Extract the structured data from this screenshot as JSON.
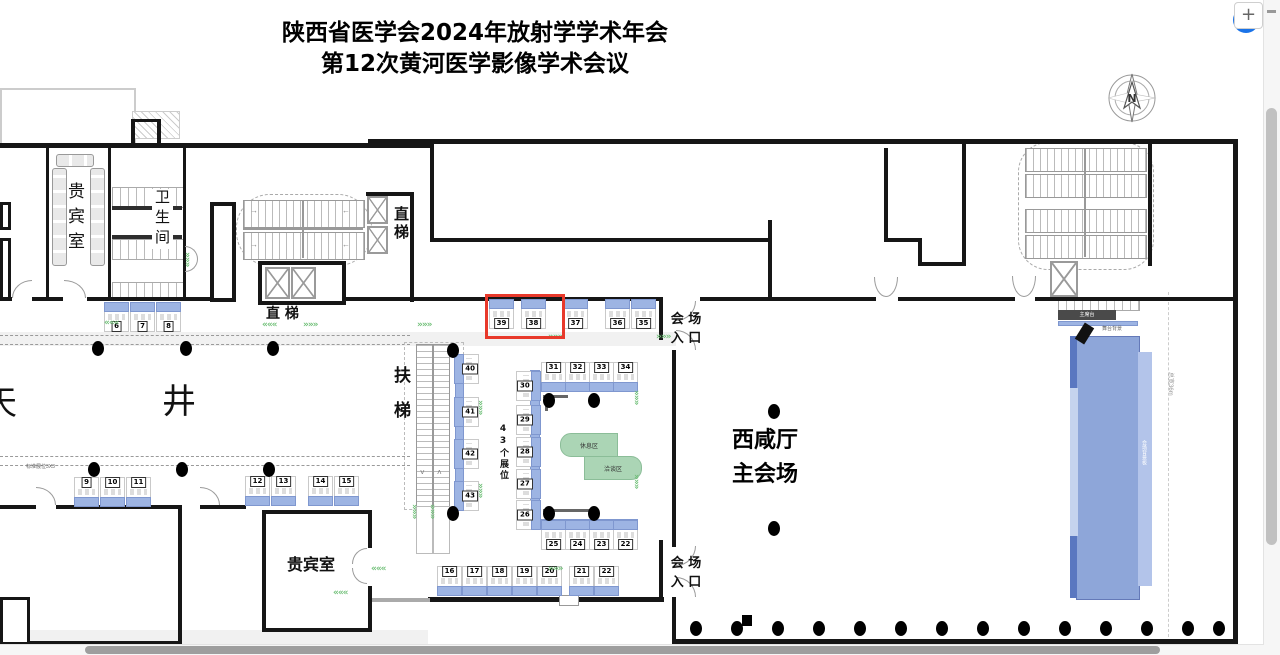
{
  "title": {
    "line1": "陕西省医学会2024年放射学学术年会",
    "line2": "第12次黄河医学影像学术会议"
  },
  "toolbar": {
    "zoom_in": "+"
  },
  "compass": {
    "north": "N"
  },
  "labels": {
    "vip_room_top": "贵宾室",
    "restroom": "卫生间",
    "elevator_center": "直 梯",
    "elevator_right": "直梯",
    "escalator": "扶梯",
    "atrium_left": "天",
    "atrium_right": "井",
    "booth_count": "43个展位",
    "vip_room_bottom": "贵宾室",
    "hall_line1": "西咸厅",
    "hall_line2": "主会场",
    "entrance_top_l1": "会 场",
    "entrance_top_l2": "入 口",
    "entrance_bottom_l1": "会 场",
    "entrance_bottom_l2": "入 口",
    "rest_area_top": "休息区",
    "rest_area_bottom": "洽谈区",
    "stage_bar": "主席台",
    "stage_note": "舞台背景",
    "stage_board": "会场背景板",
    "width_note": "总宽36m",
    "standard_booth_note": "标准展位3X3"
  },
  "colors": {
    "booth_blue": "#9db4e3",
    "highlight_red": "#e8392b",
    "chevron_green": "#6fbf77",
    "stage_green": "#abd5b5",
    "stage_blue": "#8ea6d9",
    "accent_blue": "#1a73e8"
  },
  "highlight": {
    "x": 485,
    "y": 294,
    "w": 74,
    "h": 39
  },
  "booths": [
    {
      "n": "6",
      "x": 104,
      "y": 302,
      "s": "N"
    },
    {
      "n": "7",
      "x": 130,
      "y": 302,
      "s": "N"
    },
    {
      "n": "8",
      "x": 156,
      "y": 302,
      "s": "N"
    },
    {
      "n": "39",
      "x": 489,
      "y": 299,
      "s": "N"
    },
    {
      "n": "38",
      "x": 521,
      "y": 299,
      "s": "N"
    },
    {
      "n": "37",
      "x": 563,
      "y": 299,
      "s": "N"
    },
    {
      "n": "36",
      "x": 605,
      "y": 299,
      "s": "N"
    },
    {
      "n": "35",
      "x": 631,
      "y": 299,
      "s": "N"
    },
    {
      "n": "9",
      "x": 74,
      "y": 477,
      "s": "S"
    },
    {
      "n": "10",
      "x": 100,
      "y": 477,
      "s": "S"
    },
    {
      "n": "11",
      "x": 126,
      "y": 477,
      "s": "S"
    },
    {
      "n": "12",
      "x": 245,
      "y": 476,
      "s": "S"
    },
    {
      "n": "13",
      "x": 271,
      "y": 476,
      "s": "S"
    },
    {
      "n": "14",
      "x": 308,
      "y": 476,
      "s": "S"
    },
    {
      "n": "15",
      "x": 334,
      "y": 476,
      "s": "S"
    },
    {
      "n": "16",
      "x": 437,
      "y": 566,
      "s": "S"
    },
    {
      "n": "17",
      "x": 462,
      "y": 566,
      "s": "S"
    },
    {
      "n": "18",
      "x": 487,
      "y": 566,
      "s": "S"
    },
    {
      "n": "19",
      "x": 512,
      "y": 566,
      "s": "S"
    },
    {
      "n": "20",
      "x": 537,
      "y": 566,
      "s": "S"
    },
    {
      "n": "21",
      "x": 569,
      "y": 566,
      "s": "S"
    },
    {
      "n": "22",
      "x": 594,
      "y": 566,
      "s": "S"
    },
    {
      "n": "40",
      "x": 454,
      "y": 354,
      "s": "W"
    },
    {
      "n": "41",
      "x": 454,
      "y": 397,
      "s": "W"
    },
    {
      "n": "42",
      "x": 454,
      "y": 439,
      "s": "W"
    },
    {
      "n": "43",
      "x": 454,
      "y": 481,
      "s": "W"
    },
    {
      "n": "31",
      "x": 541,
      "y": 362,
      "s": "S"
    },
    {
      "n": "32",
      "x": 565,
      "y": 362,
      "s": "S"
    },
    {
      "n": "33",
      "x": 589,
      "y": 362,
      "s": "S"
    },
    {
      "n": "34",
      "x": 613,
      "y": 362,
      "s": "S"
    },
    {
      "n": "30",
      "x": 516,
      "y": 371,
      "s": "E"
    },
    {
      "n": "29",
      "x": 516,
      "y": 405,
      "s": "E"
    },
    {
      "n": "28",
      "x": 516,
      "y": 437,
      "s": "E"
    },
    {
      "n": "27",
      "x": 516,
      "y": 469,
      "s": "E"
    },
    {
      "n": "26",
      "x": 516,
      "y": 500,
      "s": "E"
    },
    {
      "n": "25",
      "x": 541,
      "y": 520,
      "s": "N"
    },
    {
      "n": "24",
      "x": 565,
      "y": 520,
      "s": "N"
    },
    {
      "n": "23",
      "x": 589,
      "y": 520,
      "s": "N"
    },
    {
      "n": "22",
      "x": 613,
      "y": 520,
      "s": "N"
    }
  ],
  "dots": [
    [
      92,
      341
    ],
    [
      180,
      341
    ],
    [
      267,
      341
    ],
    [
      447,
      343
    ],
    [
      88,
      462
    ],
    [
      176,
      462
    ],
    [
      263,
      462
    ],
    [
      447,
      506
    ],
    [
      543,
      393
    ],
    [
      588,
      393
    ],
    [
      543,
      506
    ],
    [
      588,
      506
    ],
    [
      768,
      404
    ],
    [
      768,
      521
    ],
    [
      690,
      621
    ],
    [
      731,
      621
    ],
    [
      772,
      621
    ],
    [
      813,
      621
    ],
    [
      854,
      621
    ],
    [
      895,
      621
    ],
    [
      936,
      621
    ],
    [
      977,
      621
    ],
    [
      1018,
      621
    ],
    [
      1059,
      621
    ],
    [
      1100,
      621
    ],
    [
      1141,
      621
    ],
    [
      1182,
      621
    ],
    [
      1213,
      621
    ]
  ],
  "chevrons": [
    {
      "x": 104,
      "y": 318,
      "d": "l"
    },
    {
      "x": 262,
      "y": 320,
      "d": "l"
    },
    {
      "x": 303,
      "y": 320,
      "d": "r"
    },
    {
      "x": 417,
      "y": 320,
      "d": "r"
    },
    {
      "x": 548,
      "y": 332,
      "d": "r"
    },
    {
      "x": 656,
      "y": 332,
      "d": "r"
    },
    {
      "x": 192,
      "y": 252,
      "d": "dn"
    },
    {
      "x": 641,
      "y": 390,
      "d": "dn"
    },
    {
      "x": 641,
      "y": 474,
      "d": "dn"
    },
    {
      "x": 485,
      "y": 400,
      "d": "dn"
    },
    {
      "x": 485,
      "y": 483,
      "d": "dn"
    },
    {
      "x": 419,
      "y": 504,
      "d": "dn"
    },
    {
      "x": 437,
      "y": 504,
      "d": "dn"
    },
    {
      "x": 371,
      "y": 564,
      "d": "l"
    },
    {
      "x": 548,
      "y": 564,
      "d": "r"
    },
    {
      "x": 333,
      "y": 588,
      "d": "l"
    }
  ]
}
